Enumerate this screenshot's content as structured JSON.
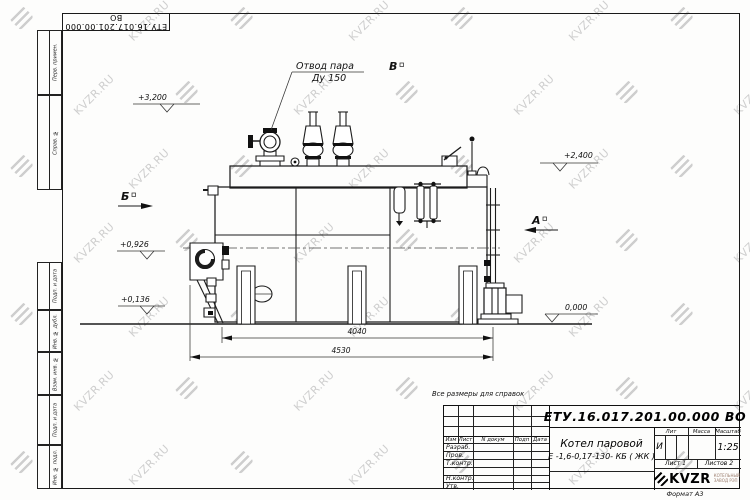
{
  "watermark": {
    "text": "KVZR.RU"
  },
  "margin": {
    "top_left_number": "ЕТУ.16.017.201.00.000  ВО",
    "format_label": "Формат А3",
    "top_boxes": [
      "Перв. примен.",
      "Справ. №"
    ],
    "bottom_boxes": [
      "Подп. и дата",
      "Инв. № дубл.",
      "Взам. инв. №",
      "Подп. и дата",
      "Инв. № подл."
    ]
  },
  "drawing": {
    "callout": {
      "line1": "Отвод пара",
      "line2": "Ду 150"
    },
    "elevations": {
      "top": "+3,200",
      "right": "+2,400",
      "burner": "+0,926",
      "lower": "+0,136",
      "ground": "0,000"
    },
    "dims": {
      "inner": "4040",
      "outer": "4530"
    },
    "views": {
      "a": "А",
      "b": "Б",
      "v": "В"
    }
  },
  "title_block": {
    "note": "Все размеры для справок",
    "doc_number": "ЕТУ.16.017.201.00.000  ВО",
    "name_line1": "Котел паровой",
    "name_line2": "Е -1,6-0,17-130- КБ ( ЖК )",
    "col_izm": "Изм",
    "col_list": "Лист",
    "col_ndokum": "N докум",
    "col_podp": "Подп",
    "col_data": "Дата",
    "col_lit": "Лит",
    "col_massa": "Масса",
    "col_masshtab": "Масштаб",
    "roles": [
      "Разраб.",
      "Пров.",
      "Т.контр.",
      "",
      "Н.контр.",
      "Утв."
    ],
    "lit_value": "И",
    "scale": "1:25",
    "sheet": "Лист 1",
    "sheets": "Листов 2",
    "logo": {
      "text": "KVZR",
      "sub1": "КОТЕЛЬНЫЙ",
      "sub2": "ЗАВОД РЭП"
    }
  }
}
